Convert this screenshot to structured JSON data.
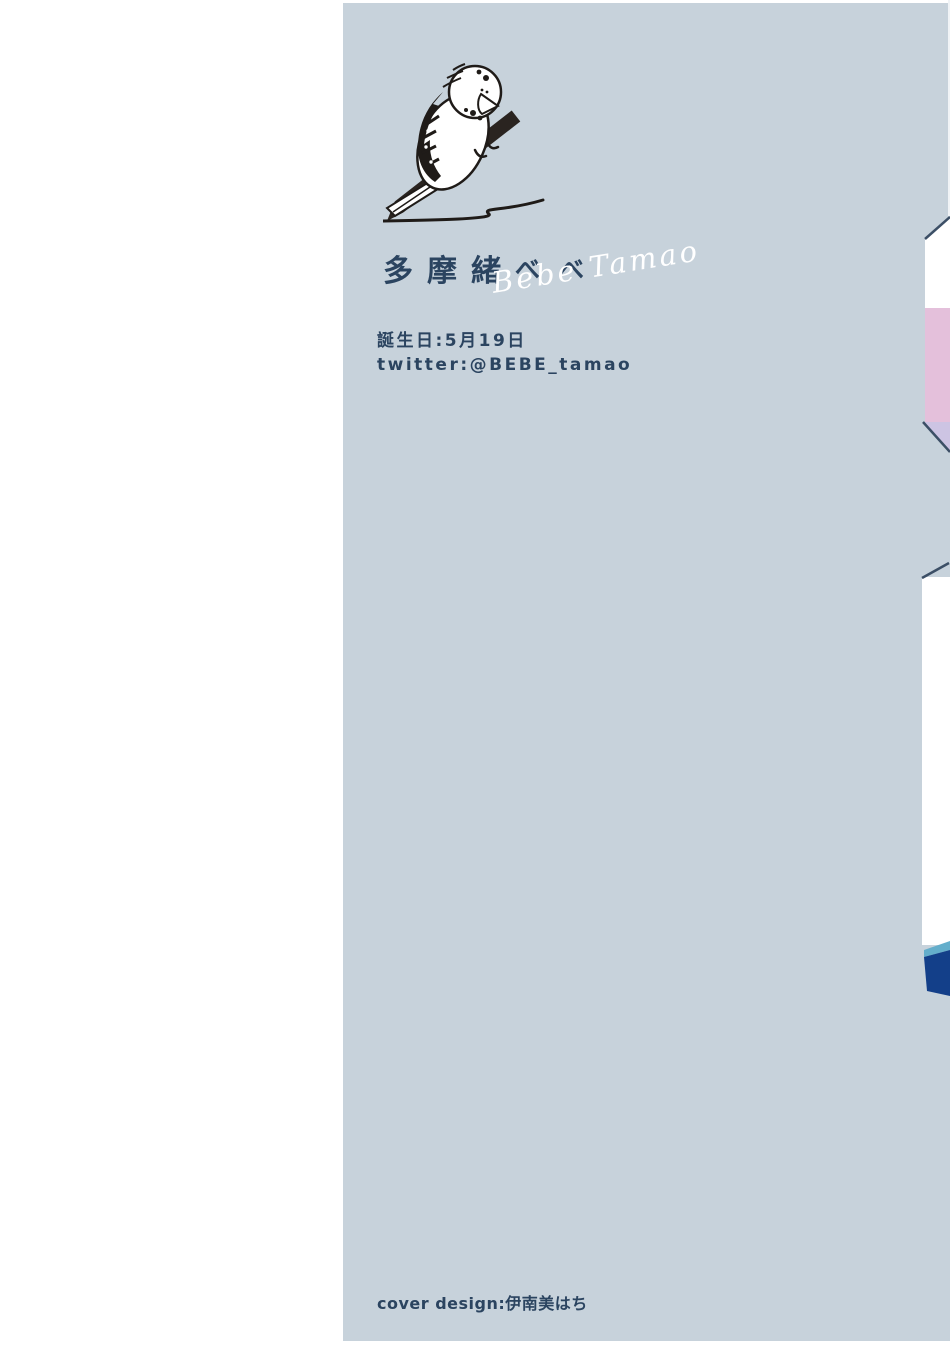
{
  "page": {
    "background": "#ffffff",
    "type": "book-inner-flap-author-profile"
  },
  "panel": {
    "background": "#c7d2db"
  },
  "author_profile": {
    "illustration": "budgerigar-perched-on-pencil-drawing-a-line",
    "name_kanji_main": "多摩緒",
    "name_kana": "べべ",
    "name_full": "多摩緒べべ",
    "signature": "Bebe Tamao",
    "birthday_label": "誕生日:5月19日",
    "twitter_label": "twitter:@BEBE_tamao"
  },
  "footer": {
    "credit": "cover design:伊南美はち"
  },
  "colors": {
    "text_navy": "#2b4460",
    "panel_blue_gray": "#c7d2db",
    "illustration_ink": "#1f1b18",
    "signature_white": "#ffffff",
    "cover_edge_white": "#ffffff",
    "cover_edge_pink": "#e4c0db",
    "cover_edge_lavender": "#cdc4e3",
    "cover_edge_navy": "#133f89",
    "cover_edge_teal": "#64aecb",
    "cover_edge_line": "#3c4f66"
  }
}
